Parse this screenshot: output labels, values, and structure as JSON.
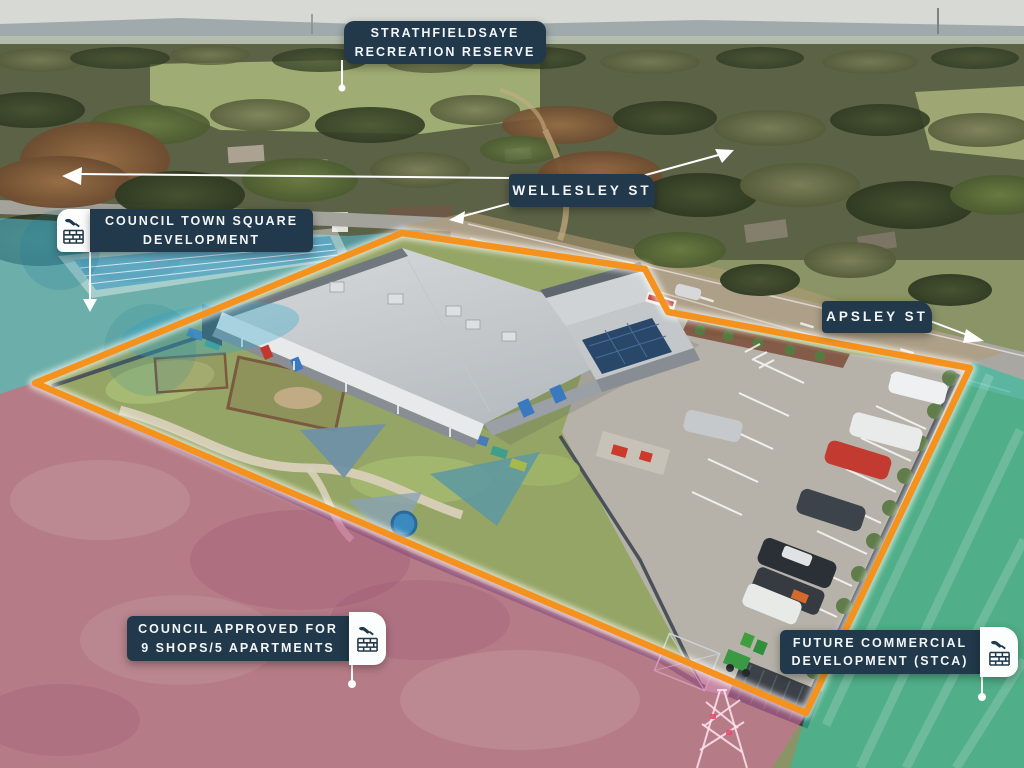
{
  "annotations": {
    "reserve": {
      "line1": "STRATHFIELDSAYE",
      "line2": "RECREATION RESERVE"
    },
    "wellesley": {
      "label": "WELLESLEY ST"
    },
    "town_square": {
      "line1": "COUNCIL TOWN SQUARE",
      "line2": "DEVELOPMENT"
    },
    "apsley": {
      "label": "APSLEY ST"
    },
    "council_approved": {
      "line1": "COUNCIL APPROVED FOR",
      "line2": "9 SHOPS/5 APARTMENTS"
    },
    "future_commercial": {
      "line1": "FUTURE COMMERCIAL",
      "line2": "DEVELOPMENT (STCA)"
    }
  },
  "icons": {
    "construction": "construction-bricks-trowel-icon",
    "arrows": [
      "arrow-west-icon",
      "arrow-northeast-icon",
      "arrow-southwest-icon",
      "arrow-east-icon",
      "arrow-down-icon"
    ],
    "leader_dots": "leader-dot-marker"
  },
  "colors": {
    "label_navy": "#21394a",
    "boundary_orange": "#f5921e",
    "overlay_cyan": "#54c3e0",
    "overlay_pink": "#d867a2",
    "overlay_teal": "#2abf9e",
    "leader_white": "#ffffff"
  }
}
